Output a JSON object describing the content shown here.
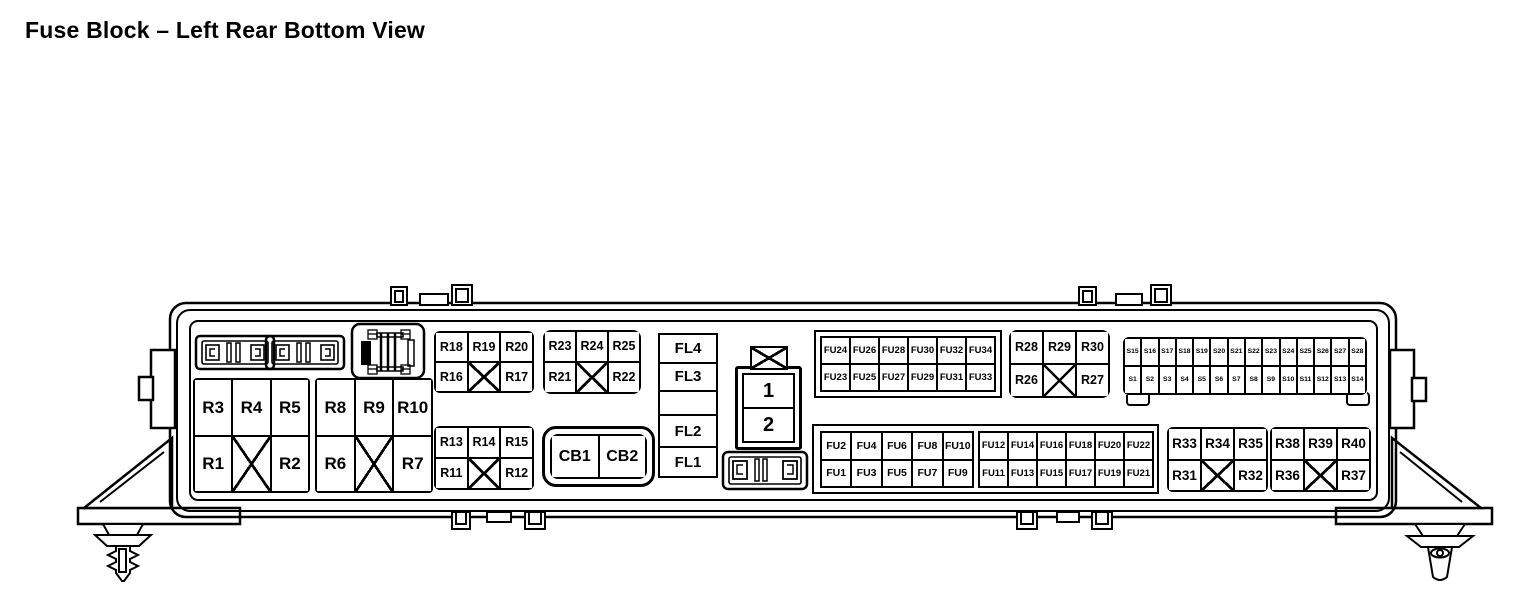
{
  "title": "Fuse Block – Left Rear Bottom View",
  "colors": {
    "line": "#000000",
    "background": "#ffffff"
  },
  "icons": {
    "cross": "x-cross-no-component",
    "fusible_link": "fusible-link-icon",
    "relay_module": "relay-module-icon",
    "push_pin": "push-pin-fastener-icon"
  },
  "connector": {
    "cells": [
      "1",
      "2"
    ]
  },
  "grids": [
    {
      "id": "relay-r1-r5",
      "rows": [
        [
          "R3",
          "R4",
          "R5"
        ],
        [
          "R1",
          "#X",
          "R2"
        ]
      ]
    },
    {
      "id": "relay-r6-r10",
      "rows": [
        [
          "R8",
          "R9",
          "R10"
        ],
        [
          "R6",
          "#X",
          "R7"
        ]
      ]
    },
    {
      "id": "relay-r16-r20",
      "rows": [
        [
          "R18",
          "R19",
          "R20"
        ],
        [
          "R16",
          "#X",
          "R17"
        ]
      ]
    },
    {
      "id": "relay-r21-r25",
      "rows": [
        [
          "R23",
          "R24",
          "R25"
        ],
        [
          "R21",
          "#X",
          "R22"
        ]
      ]
    },
    {
      "id": "relay-r11-r15",
      "rows": [
        [
          "R13",
          "R14",
          "R15"
        ],
        [
          "R11",
          "#X",
          "R12"
        ]
      ]
    },
    {
      "id": "fl-column",
      "rows": [
        [
          "FL4"
        ],
        [
          "FL3"
        ],
        [
          null
        ],
        [
          "FL2"
        ],
        [
          "FL1"
        ]
      ]
    },
    {
      "id": "fu-upper",
      "rows": [
        [
          "FU24",
          "FU26",
          "FU28",
          "FU30",
          "FU32",
          "FU34"
        ],
        [
          "FU23",
          "FU25",
          "FU27",
          "FU29",
          "FU31",
          "FU33"
        ]
      ]
    },
    {
      "id": "relay-r26-r30",
      "rows": [
        [
          "R28",
          "R29",
          "R30"
        ],
        [
          "R26",
          "#X",
          "R27"
        ]
      ]
    },
    {
      "id": "s-strip",
      "rows": [
        [
          "S15",
          "S16",
          "S17",
          "S18",
          "S19",
          "S20",
          "S21",
          "S22",
          "S23",
          "S24",
          "S25",
          "S26",
          "S27",
          "S28"
        ],
        [
          "S1",
          "S2",
          "S3",
          "S4",
          "S5",
          "S6",
          "S7",
          "S8",
          "S9",
          "S10",
          "S11",
          "S12",
          "S13",
          "S14"
        ]
      ]
    },
    {
      "id": "fu-lower-left",
      "rows": [
        [
          "FU2",
          "FU4",
          "FU6",
          "FU8",
          "FU10"
        ],
        [
          "FU1",
          "FU3",
          "FU5",
          "FU7",
          "FU9"
        ]
      ]
    },
    {
      "id": "fu-lower-right",
      "rows": [
        [
          "FU12",
          "FU14",
          "FU16",
          "FU18",
          "FU20",
          "FU22"
        ],
        [
          "FU11",
          "FU13",
          "FU15",
          "FU17",
          "FU19",
          "FU21"
        ]
      ]
    },
    {
      "id": "relay-r31-r35",
      "rows": [
        [
          "R33",
          "R34",
          "R35"
        ],
        [
          "R31",
          "#X",
          "R32"
        ]
      ]
    },
    {
      "id": "relay-r36-r40",
      "rows": [
        [
          "R38",
          "R39",
          "R40"
        ],
        [
          "R36",
          "#X",
          "R37"
        ]
      ]
    },
    {
      "id": "cb-block",
      "rows": [
        [
          "CB1",
          "CB2"
        ]
      ]
    }
  ]
}
